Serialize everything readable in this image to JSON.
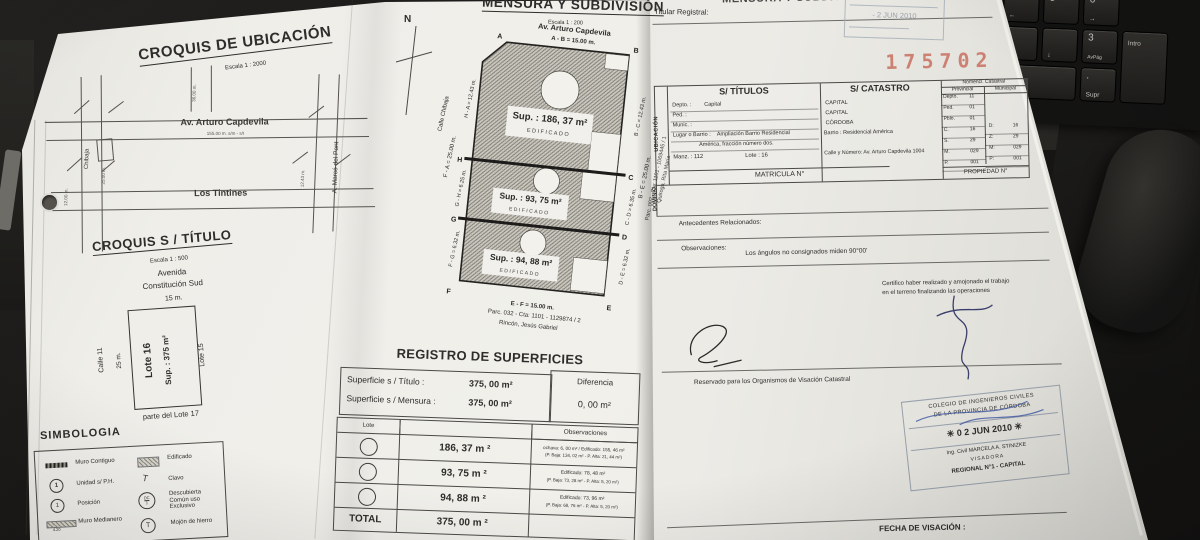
{
  "colors": {
    "file_number_red": "#c4604e",
    "stamp_blue_gray": "#8e98a4",
    "pen_blue": "#3b55a5",
    "paper": "#edece7"
  },
  "photo": {
    "file_number": "175702",
    "keyboard_keys": [
      {
        "main": "4",
        "sub": "←"
      },
      {
        "main": "5",
        "sub": ""
      },
      {
        "main": "6",
        "sub": "→"
      },
      {
        "main": "",
        "sub": "Fin"
      },
      {
        "main": "",
        "sub": "↓"
      },
      {
        "main": "3",
        "sub": "AvPág"
      },
      {
        "main": "",
        "sub": "Intro"
      },
      {
        "main": "0",
        "sub": "Ins"
      },
      {
        "main": ".",
        "sub": "Supr"
      }
    ]
  },
  "croquis_ubicacion": {
    "title": "CROQUIS  DE  UBICACIÓN",
    "scale": "Escala   1 : 2000",
    "street_avenue": "Av. Arturo Capdevila",
    "street_avenue_dim": "155.00 m.   s/m - s/t",
    "street_tintines": "Los Tintines",
    "street_chibaja": "Chibaja",
    "street_marco": "A. Marcó del Pont",
    "dim_1": "25.00 m.",
    "dim_2": "12.00 m.",
    "dim_3": "12.43 m.",
    "dim_4": "36.00 m."
  },
  "croquis_titulo": {
    "title": "CROQUIS  S / TÍTULO",
    "scale": "Escala   1 : 500",
    "street_top_1": "Avenida",
    "street_top_2": "Constitución Sud",
    "dim_top": "15 m.",
    "street_left": "Calle 11",
    "dim_left": "25 m.",
    "lot_label": "Lote 16",
    "lot_sup": "Sup. : 375 m²",
    "right_label": "Lote 15",
    "bottom_label": "parte del Lote 17"
  },
  "simbologia": {
    "title": "SIMBOLOGIA",
    "col1": [
      {
        "label": "Muro Contiguo"
      },
      {
        "label": "Unidad s/ P.H."
      },
      {
        "label": "Posición"
      },
      {
        "label": "Muro Medianero"
      }
    ],
    "col1_note": "4.20",
    "col2": [
      {
        "label": "Edificado"
      },
      {
        "label": "Clavo"
      },
      {
        "label": "Descubierta Común uso Exclusivo"
      },
      {
        "label": "Mojón de hierro"
      }
    ],
    "sym_unidad": "1",
    "sym_posicion": "1",
    "sym_clavo": "T",
    "sym_dc_top": "DC",
    "sym_dc_bottom": "1",
    "sym_mojon": "T"
  },
  "mensura": {
    "title": "MENSURA  Y  SUBDIVISIÓN",
    "scale": "Escala   1 : 200",
    "north": "N",
    "street_top": "Av. Arturo Capdevila",
    "dim_ab": "A - B = 15.00 m.",
    "street_left": "Calle Chibaja",
    "dim_fa": "F - A = 25.00 m.",
    "dim_ha": "H - A = 12.43 m.",
    "dim_gh": "G - H = 6.25 m.",
    "dim_fg": "F - G = 6.32 m.",
    "dim_be": "B - E = 25.00 m.",
    "dim_bc": "B - C = 12.43 m.",
    "dim_cd": "C - D = 6.35 m.",
    "dim_de": "D - E = 6.32 m.",
    "dim_ef": "E - F = 15.00 m.",
    "neighbor_bottom_1": "Parc. 032 - Cta: 1101 - 1129874 / 2",
    "neighbor_bottom_2": "Rincón, Jesús Gabriel",
    "neighbor_right_1": "Parc. 002 - Cta: 1101 - 1069445 / 1",
    "neighbor_right_2": "Quiroga, Rita María",
    "lots": [
      {
        "sup": "Sup. :  186, 37 m²",
        "tag": "EDIFICADO"
      },
      {
        "sup": "Sup. :  93, 75 m²",
        "tag": "EDIFICADO"
      },
      {
        "sup": "Sup. :  94, 88 m²",
        "tag": "EDIFICADO"
      }
    ],
    "points": {
      "a": "A",
      "b": "B",
      "c": "C",
      "d": "D",
      "e": "E",
      "f": "F",
      "g": "G",
      "h": "H"
    }
  },
  "registro": {
    "title": "REGISTRO DE SUPERFICIES",
    "sup_titulo_label": "Superficie  s / Título :",
    "sup_titulo_value": "375, 00 m²",
    "sup_mensura_label": "Superficie  s / Mensura :",
    "sup_mensura_value": "375, 00 m²",
    "diferencia_label": "Diferencia",
    "diferencia_value": "0, 00 m²",
    "col_lote": "Lote",
    "col_obs": "Observaciones",
    "rows": [
      {
        "sup": "186, 37 m ²",
        "obs1": "ochava: 6, 00 m² / Edificado: 155, 46 m²",
        "obs2": "(P. Baja: 134, 02 m² - P. Alta: 21, 44 m²)"
      },
      {
        "sup": "93, 75 m ²",
        "obs1": "Edificado: 78, 48 m²",
        "obs2": "(P. Baja: 73, 28 m² - P. Alta: 5, 20 m²)"
      },
      {
        "sup": "94, 88 m ²",
        "obs1": "Edificado: 73, 96 m²",
        "obs2": "(P. Baja: 68, 76 m² - P. Alta: 5, 20 m²)"
      }
    ],
    "total_label": "TOTAL",
    "total_value": "375, 00 m ²"
  },
  "right_page": {
    "header_title": "MENSURA Y SUBDIVISIÓN",
    "titular": "Titular Registral:",
    "stamp_top_date": "- 2 JUN 2010",
    "table": {
      "sec_ubicacion": "UBICACIÓN",
      "sec_dominio": "DOMINIO",
      "h_titulos": "S/ TÍTULOS",
      "h_catastro": "S/ CATASTRO",
      "h_nomencl": "Nomencl. Catastral",
      "h_prov": "Provincial",
      "h_mun": "Municipal",
      "rows_left": [
        {
          "label": "Depto. :",
          "value": "Capital"
        },
        {
          "label": "Ped. :",
          "value": ""
        },
        {
          "label": "Munic. :",
          "value": ""
        },
        {
          "label": "Lugar o Barrio :",
          "value": "Ampliación Barrio Residencial"
        },
        {
          "label": "",
          "value": "América, fracción número dos."
        },
        {
          "label": "Manz. :  112",
          "value": "Lote :  16"
        }
      ],
      "rows_cat": [
        "CAPITAL",
        "CAPITAL",
        "CÓRDOBA",
        "Barrio :   Residencial América",
        "",
        "Calle y Número:   Av. Arturo Capdevila 1004"
      ],
      "prov": [
        [
          "Depto.",
          "11"
        ],
        [
          "Ped.",
          "01"
        ],
        [
          "Pblo.",
          "01"
        ],
        [
          "C.",
          "16"
        ],
        [
          "S.",
          "29"
        ],
        [
          "M.",
          "029"
        ],
        [
          "P.",
          "001"
        ]
      ],
      "mun": [
        [
          "D:",
          "16"
        ],
        [
          "Z:",
          "29"
        ],
        [
          "M:",
          "029"
        ],
        [
          "P:",
          "001"
        ]
      ],
      "matricula": "MATRICULA N°",
      "propiedad": "PROPIEDAD N°"
    },
    "antecedentes": "Antecedentes Relacionados:",
    "observaciones_label": "Observaciones:",
    "observaciones_text": "Los ángulos no consignados miden 90°00'",
    "certifico_1": "Certifico haber realizado y amojonado el trabajo",
    "certifico_2": "en el terreno finalizando las operaciones",
    "reservado": "Reservado para los Organismos de Visación Catastral",
    "stamp": {
      "line1": "COLEGIO DE INGENIEROS CIVILES",
      "line2": "DE LA PROVINCIA DE CÓRDOBA",
      "date": "✳  0 2 JUN 2010  ✳",
      "name": "Ing. Civil MARCELA A. STINIZKE",
      "role": "VISADORA",
      "region": "REGIONAL N°1  -  CAPITAL"
    },
    "fecha_visacion": "FECHA DE VISACIÓN :"
  }
}
